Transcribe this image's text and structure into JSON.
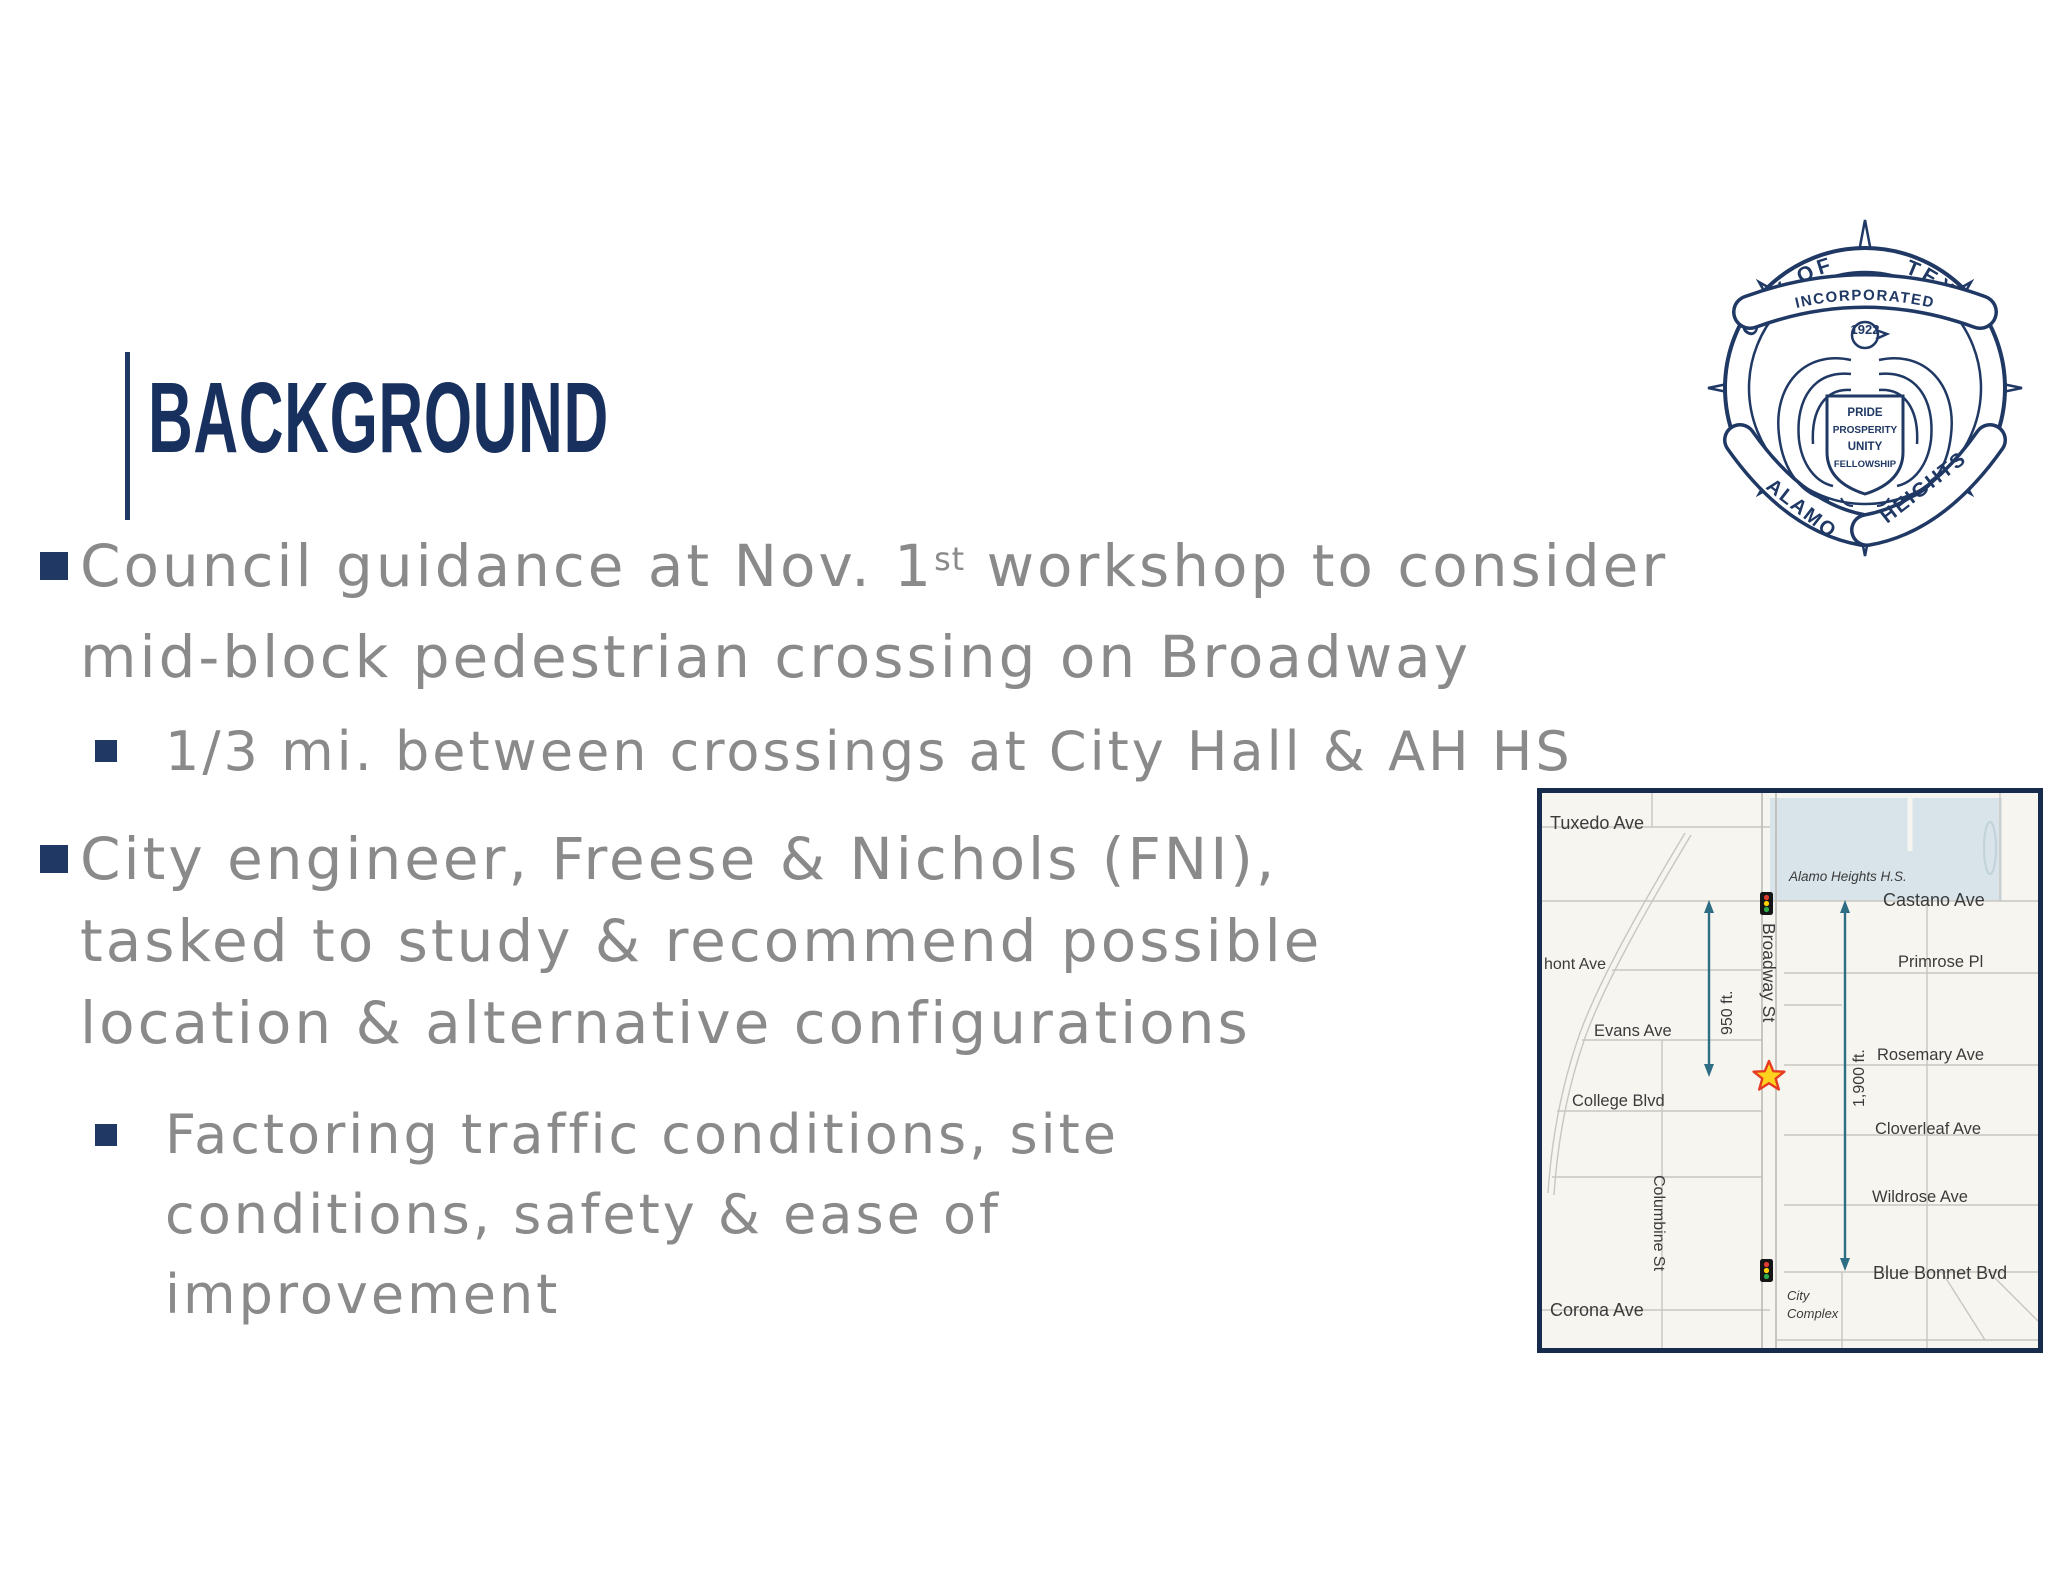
{
  "slide": {
    "title": "BACKGROUND"
  },
  "bullets": {
    "b1_l1_pre": "Council guidance at Nov. 1",
    "b1_l1_sup": "st",
    "b1_l1_post": " workshop to consider",
    "b1_l2": "mid-block pedestrian crossing on Broadway",
    "sub1": "1/3 mi. between crossings at City Hall & AH HS",
    "b2_l1": "City engineer, Freese & Nichols (FNI),",
    "b2_l2": "tasked to study & recommend possible",
    "b2_l3": "location & alternative configurations",
    "sub2_l1": "Factoring traffic conditions, site",
    "sub2_l2": "conditions, safety & ease of",
    "sub2_l3": "improvement"
  },
  "seal": {
    "top_banner": "INCORPORATED",
    "year": "1922",
    "left_banner": "CITY OF",
    "right_banner": "TEXAS",
    "bottom_left_banner": "ALAMO",
    "bottom_right_banner": "HEIGHTS",
    "shield": [
      "PRIDE",
      "PROSPERITY",
      "UNITY",
      "FELLOWSHIP"
    ]
  },
  "map": {
    "labels": {
      "tuxedo": "Tuxedo Ave",
      "school": "Alamo Heights H.S.",
      "castano": "Castano Ave",
      "mont": "hont Ave",
      "primrose": "Primrose Pl",
      "evans": "Evans Ave",
      "rosemary": "Rosemary Ave",
      "college": "College Blvd",
      "cloverleaf": "Cloverleaf Ave",
      "wildrose": "Wildrose Ave",
      "columbine": "Columbine St",
      "broadway": "Broadway St",
      "bluebonnet": "Blue Bonnet Bvd",
      "corona": "Corona Ave",
      "city_complex_line1": "City",
      "city_complex_line2": "Complex",
      "dist_950": "950 ft.",
      "dist_1900": "1,900 ft."
    },
    "colors": {
      "arrow": "#2d6e85",
      "star_fill": "#ffd21e",
      "star_stroke": "#e63b23",
      "school_fill": "#d8e4ea",
      "background": "#f7f5f0",
      "border": "#172b4d",
      "navy": "#1f3864",
      "text_gray": "#8a8a8a"
    }
  }
}
